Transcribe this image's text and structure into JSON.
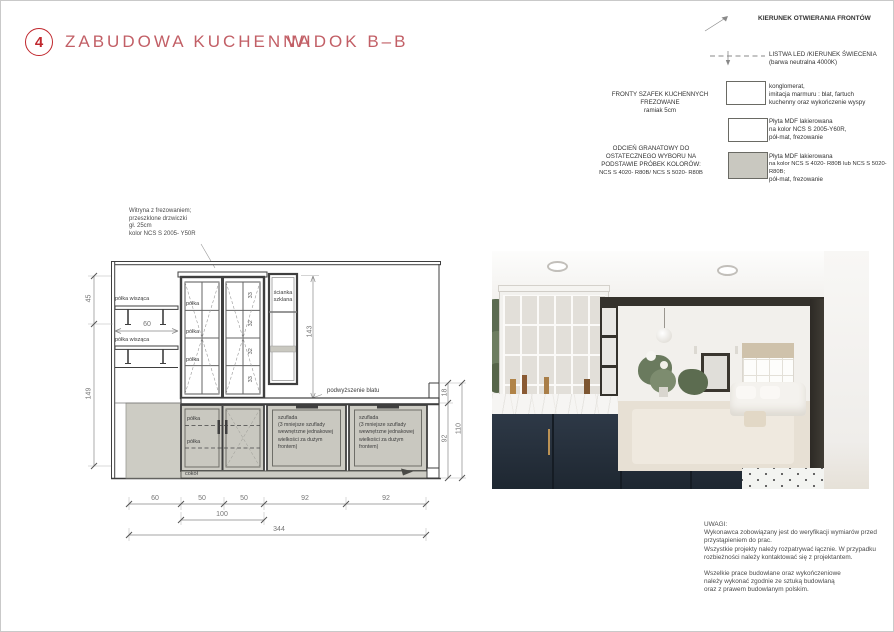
{
  "header": {
    "number": "4",
    "title": "ZABUDOWA KUCHENNA",
    "subtitle": "WIDOK B–B"
  },
  "legend": {
    "opening_label": "KIERUNEK OTWIERANIA FRONTÓW",
    "led_line1": "LISTWA LED /KIERUNEK ŚWIECENIA",
    "led_line2": "(barwa neutralna 4000K)",
    "items": [
      {
        "swatch": "white",
        "lines": [
          "konglomerat,",
          "imitacja marmuru : blat, fartuch",
          "kuchenny oraz wykończenie wyspy"
        ]
      },
      {
        "swatch": "white",
        "lines": [
          "Płyta MDF lakierowana",
          "na kolor NCS S 2005-Y60R,",
          "pół-mat, frezowanie"
        ]
      },
      {
        "swatch": "gray",
        "lines": [
          "Płyta MDF lakierowana",
          "na kolor NCS S 4020- R80B lub NCS S 5020- R80B;",
          "pół-mat, frezowanie"
        ]
      }
    ],
    "note_fronts": [
      "FRONTY SZAFEK KUCHENNYCH",
      "FREZOWANE",
      "ramiak 5cm"
    ],
    "note_navy": [
      "ODCIEŃ GRANATOWY DO",
      "OSTATECZNEGO WYBORU NA",
      "PODSTAWIE PRÓBEK KOLORÓW:",
      "NCS S 4020- R80B/ NCS S 5020- R80B"
    ]
  },
  "drawing": {
    "annotation": [
      "Witryna z frezowaniem;",
      "przeszklone drzwiczki",
      "gł. 25cm",
      "kolor NCS S 2005- Y50R"
    ],
    "labels": {
      "hanging_shelf": "półka wisząca",
      "shelf": "półka",
      "glass_wall_1": "ścianka",
      "glass_wall_2": "szklana",
      "counter_raise": "podwyższenie blatu",
      "plinth": "cokół",
      "drawer_lines": [
        "szuflada",
        "(3 mniejsze szuflady",
        "wewnętrzne jednakowej",
        "wielkości za dużym",
        "frontem)"
      ]
    },
    "dims": {
      "pane_heights": [
        "33",
        "32",
        "32",
        "33"
      ],
      "glass_height": "143",
      "shelf_width": "60",
      "left": [
        "45",
        "149"
      ],
      "right": [
        "18",
        "92",
        "110"
      ],
      "bottom_row1": [
        "60",
        "50",
        "50",
        "92",
        "92"
      ],
      "bottom_row2": "100",
      "bottom_total": "344"
    }
  },
  "notes": {
    "title": "UWAGI:",
    "para1": [
      "Wykonawca zobowiązany jest do weryfikacji wymiarów przed",
      "przystąpieniem do prac.",
      "Wszystkie projekty należy rozpatrywać łącznie. W przypadku",
      "rozbieżności należy kontaktować się z projektantem."
    ],
    "para2": [
      "Wszelkie prace budowlane oraz wykończeniowe",
      "należy wykonać zgodnie ze sztuką budowlaną",
      "oraz z prawem budowlanym polskim."
    ]
  },
  "colors": {
    "accent_red": "#c0272d",
    "title_red": "#c25f66",
    "cabinet_gray": "#cdccc4",
    "swatch_gray": "#c9c8c0",
    "navy": "#27313c",
    "line": "#3f3f3f",
    "dim_text": "#767676"
  }
}
